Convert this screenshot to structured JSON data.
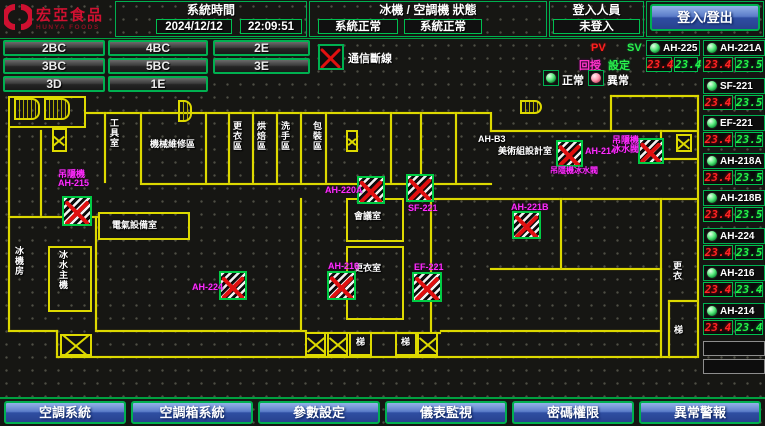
{
  "header": {
    "logo": {
      "title": "宏亞食品",
      "subtitle": "HUNYA FOODS"
    },
    "system_time": {
      "label": "系統時間",
      "date": "2024/12/12",
      "time": "22:09:51"
    },
    "machine_status": {
      "label": "冰機 / 空調機 狀態",
      "chiller_status": "系統正常",
      "ahu_status": "系統正常"
    },
    "login": {
      "label": "登入人員",
      "status": "未登入",
      "button_label": "登入/登出"
    }
  },
  "floor_buttons": [
    [
      "2BC",
      "4BC",
      "2E"
    ],
    [
      "3BC",
      "5BC",
      "3E"
    ],
    [
      "3D",
      "1E"
    ]
  ],
  "status_legend": {
    "comm_loss": "通信斷線",
    "normal": "正常",
    "abnormal": "異常",
    "pv": "PV",
    "sv": "SV",
    "feedback": "回授",
    "setpoint": "設定"
  },
  "sidebar": {
    "featured_unit": {
      "name": "AH-225",
      "pv": "23.4",
      "sv": "23.4"
    },
    "units": [
      {
        "name": "AH-221A",
        "pv": "23.4",
        "sv": "23.5"
      },
      {
        "name": "SF-221",
        "pv": "23.4",
        "sv": "23.5"
      },
      {
        "name": "EF-221",
        "pv": "23.4",
        "sv": "23.5"
      },
      {
        "name": "AH-218A",
        "pv": "23.4",
        "sv": "23.5"
      },
      {
        "name": "AH-218B",
        "pv": "23.4",
        "sv": "23.5"
      },
      {
        "name": "AH-224",
        "pv": "23.4",
        "sv": "23.5"
      },
      {
        "name": "AH-216",
        "pv": "23.4",
        "sv": "23.4"
      },
      {
        "name": "AH-214",
        "pv": "23.4",
        "sv": "23.4"
      }
    ],
    "empty_slots": 2
  },
  "floorplan": {
    "units": [
      {
        "id": "ah-215",
        "label_lines": [
          "吊隱機",
          "AH-215"
        ],
        "x": 62,
        "y": 196,
        "w": 30,
        "h": 30,
        "lx": 58,
        "ly": 170
      },
      {
        "id": "ah-220a",
        "label_lines": [
          "AH-220A"
        ],
        "x": 357,
        "y": 176,
        "w": 28,
        "h": 28,
        "lx": 325,
        "ly": 186
      },
      {
        "id": "sf-221",
        "label_lines": [
          "SF-221"
        ],
        "x": 406,
        "y": 174,
        "w": 28,
        "h": 28,
        "lx": 408,
        "ly": 204
      },
      {
        "id": "ah-214",
        "label_lines": [
          "AH-214"
        ],
        "x": 556,
        "y": 140,
        "w": 27,
        "h": 27,
        "lx": 585,
        "ly": 147
      },
      {
        "id": "ahu-valve",
        "label_lines": [
          "吊隱機",
          "冰水閥"
        ],
        "x": 638,
        "y": 138,
        "w": 26,
        "h": 26,
        "lx": 612,
        "ly": 136
      },
      {
        "id": "ah-221b",
        "label_lines": [
          "AH-221B"
        ],
        "x": 512,
        "y": 211,
        "w": 29,
        "h": 28,
        "lx": 511,
        "ly": 203
      },
      {
        "id": "ah-224",
        "label_lines": [
          "AH-224"
        ],
        "x": 219,
        "y": 271,
        "w": 28,
        "h": 29,
        "lx": 192,
        "ly": 283
      },
      {
        "id": "ah-216",
        "label_lines": [
          "AH-216"
        ],
        "x": 327,
        "y": 271,
        "w": 29,
        "h": 29,
        "lx": 328,
        "ly": 262
      },
      {
        "id": "ef-221",
        "label_lines": [
          "EF-221"
        ],
        "x": 412,
        "y": 272,
        "w": 30,
        "h": 30,
        "lx": 414,
        "ly": 263
      }
    ],
    "unit_sublabels": [
      {
        "text": "吊隱機冰水閥",
        "x": 550,
        "y": 166
      }
    ],
    "rooms": [
      {
        "text": "工具室",
        "x": 109,
        "y": 118,
        "vertical": true
      },
      {
        "text": "機械維修區",
        "x": 150,
        "y": 139,
        "vertical": false
      },
      {
        "text": "更衣區",
        "x": 232,
        "y": 121,
        "vertical": true
      },
      {
        "text": "烘焙區",
        "x": 256,
        "y": 121,
        "vertical": true
      },
      {
        "text": "洗手區",
        "x": 280,
        "y": 121,
        "vertical": true
      },
      {
        "text": "包裝區",
        "x": 312,
        "y": 121,
        "vertical": true
      },
      {
        "text": "電氣設備室",
        "x": 112,
        "y": 220,
        "vertical": false
      },
      {
        "text": "冰水主機",
        "x": 58,
        "y": 250,
        "vertical": true
      },
      {
        "text": "冰機房",
        "x": 14,
        "y": 246,
        "vertical": true
      },
      {
        "text": "會議室",
        "x": 354,
        "y": 211,
        "vertical": false
      },
      {
        "text": "更衣室",
        "x": 354,
        "y": 263,
        "vertical": false
      },
      {
        "text": "美術組設計室",
        "x": 498,
        "y": 146,
        "vertical": false
      },
      {
        "text": "AH-B3",
        "x": 478,
        "y": 134,
        "vertical": false
      },
      {
        "text": "梯",
        "x": 356,
        "y": 337,
        "vertical": false
      },
      {
        "text": "梯",
        "x": 401,
        "y": 337,
        "vertical": false
      },
      {
        "text": "更衣",
        "x": 672,
        "y": 261,
        "vertical": true
      },
      {
        "text": "梯",
        "x": 674,
        "y": 325,
        "vertical": false
      }
    ],
    "shafts": [
      {
        "x": 52,
        "y": 128,
        "w": 15,
        "h": 24
      },
      {
        "x": 346,
        "y": 130,
        "w": 12,
        "h": 22
      },
      {
        "x": 676,
        "y": 134,
        "w": 16,
        "h": 18
      },
      {
        "x": 60,
        "y": 334,
        "w": 32,
        "h": 22
      },
      {
        "x": 305,
        "y": 332,
        "w": 21,
        "h": 24
      },
      {
        "x": 327,
        "y": 332,
        "w": 21,
        "h": 24
      },
      {
        "x": 417,
        "y": 332,
        "w": 21,
        "h": 24
      }
    ],
    "stairs": [
      {
        "x": 14,
        "y": 98,
        "w": 26,
        "h": 22
      },
      {
        "x": 44,
        "y": 98,
        "w": 26,
        "h": 22
      },
      {
        "x": 178,
        "y": 100,
        "w": 14,
        "h": 22
      },
      {
        "x": 520,
        "y": 100,
        "w": 22,
        "h": 14
      }
    ]
  },
  "bottom_nav": [
    "空調系統",
    "空調箱系統",
    "參數設定",
    "儀表監視",
    "密碼權限",
    "異常警報"
  ],
  "colors": {
    "accent_green": "#00b050",
    "wall_yellow": "#ddd900",
    "alarm_red": "#e01010",
    "unit_label_magenta": "#ff2bff",
    "pv_red": "#ff2424",
    "sv_green": "#25f245",
    "nav_blue": "#2f4ea2"
  }
}
